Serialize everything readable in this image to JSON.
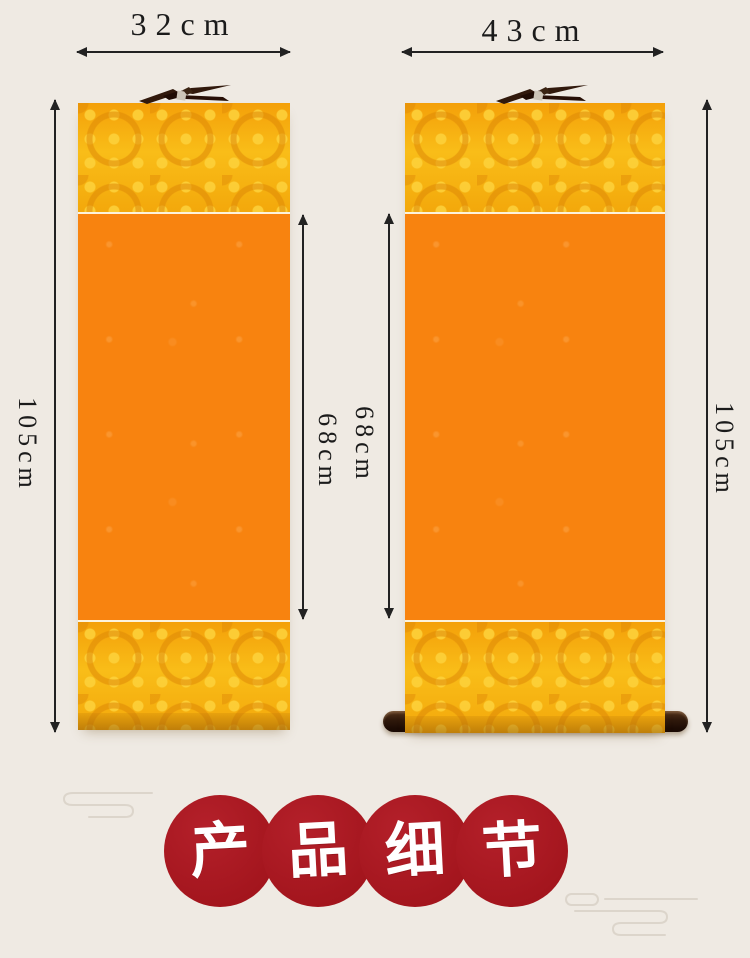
{
  "dimensions": {
    "left_width": "32cm",
    "right_width": "43cm",
    "left_outer_height": "105cm",
    "right_outer_height": "105cm",
    "left_inner_height": "68cm",
    "right_inner_height": "68cm"
  },
  "scrolls": [
    {
      "name": "narrow-scroll",
      "width_label": "32cm",
      "outer_height_label": "105cm",
      "inner_height_label": "68cm"
    },
    {
      "name": "wide-scroll",
      "width_label": "43cm",
      "outer_height_label": "105cm",
      "inner_height_label": "68cm"
    }
  ],
  "banner": {
    "text": "产品细节",
    "characters": [
      "产",
      "品",
      "细",
      "节"
    ],
    "circle_color": "#a6171e",
    "text_color": "#ffffff"
  },
  "colors": {
    "page_background": "#efeae3",
    "scroll_orange": "#f8830f",
    "brocade_gold": "#f7b10d",
    "rod_brown": "#2a160d",
    "annotation_ink": "#1b1b1b"
  }
}
